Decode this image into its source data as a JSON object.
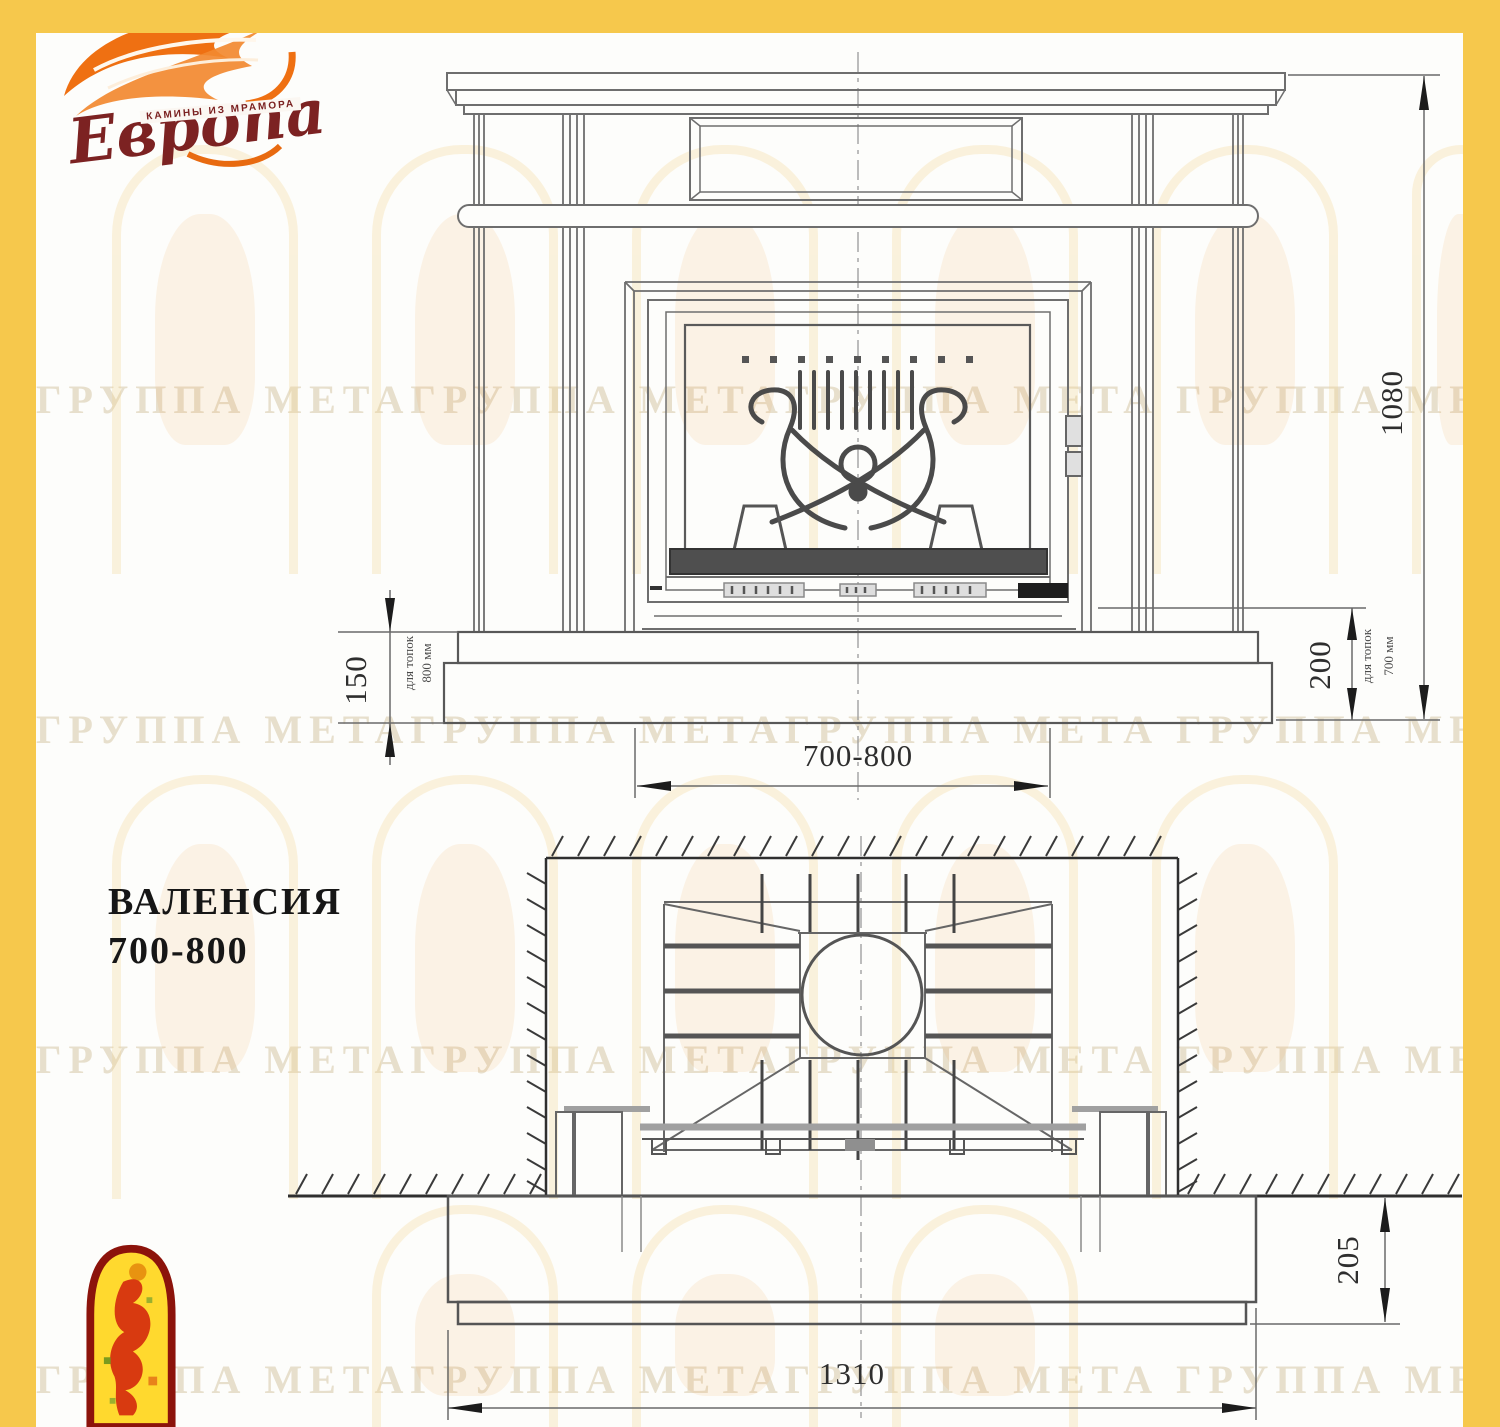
{
  "logo": {
    "name": "Европа",
    "tagline": "КАМИНЫ ИЗ МРАМОРА"
  },
  "title": {
    "line1": "ВАЛЕНСИЯ",
    "line2": "700-800"
  },
  "front": {
    "height": "1080",
    "left_offset": "150",
    "left_note1": "для топок",
    "left_note2": "800 мм",
    "right_offset": "200",
    "right_note1": "для топок",
    "right_note2": "700 мм",
    "width": "700-800"
  },
  "plan": {
    "width": "1310",
    "depth": "205"
  },
  "watermark": {
    "band": "ГРУППА МЕТАГРУППА МЕТАГРУППА МЕТА ГРУППА МЕТАГРУППА МЕТА"
  },
  "colors": {
    "border": "#f6c84c",
    "flame": "#ef7012",
    "logo_text": "#7c2222",
    "line": "#6e6e6e"
  }
}
